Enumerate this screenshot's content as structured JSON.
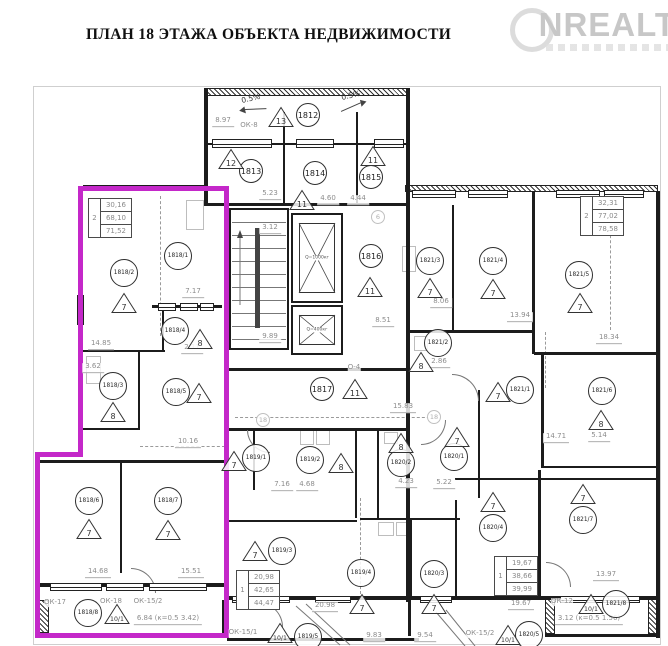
{
  "title": "ПЛАН 18 ЭТАЖА ОБЪЕКТА НЕДВИЖИМОСТИ",
  "watermark": {
    "text": "NREALT"
  },
  "colors": {
    "highlight": "#c428c9",
    "wall": "#1c1c1c",
    "dim_text": "#8d8d8d"
  },
  "rooms": [
    {
      "id": "1812",
      "x": 308,
      "y": 115,
      "tri": "13",
      "tx": 281,
      "ty": 117
    },
    {
      "id": "1813",
      "x": 251,
      "y": 171,
      "tri": "12",
      "tx": 231,
      "ty": 159
    },
    {
      "id": "1814",
      "x": 315,
      "y": 173,
      "tri": "11",
      "tx": 302,
      "ty": 200
    },
    {
      "id": "1815",
      "x": 371,
      "y": 177,
      "tri": "11",
      "tx": 373,
      "ty": 156
    },
    {
      "id": "1816",
      "x": 371,
      "y": 256,
      "tri": "11",
      "tx": 370,
      "ty": 287
    },
    {
      "id": "1817",
      "x": 322,
      "y": 389,
      "tri": "11",
      "tx": 355,
      "ty": 389
    },
    {
      "id": "1818/1",
      "x": 178,
      "y": 256,
      "tri": null,
      "tx": 0,
      "ty": 0
    },
    {
      "id": "1818/2",
      "x": 124,
      "y": 273,
      "tri": "7",
      "tx": 124,
      "ty": 303
    },
    {
      "id": "1818/3",
      "x": 113,
      "y": 386,
      "tri": "8",
      "tx": 113,
      "ty": 412
    },
    {
      "id": "1818/4",
      "x": 175,
      "y": 331,
      "tri": "8",
      "tx": 200,
      "ty": 339
    },
    {
      "id": "1818/5",
      "x": 176,
      "y": 392,
      "tri": "7",
      "tx": 199,
      "ty": 393
    },
    {
      "id": "1818/6",
      "x": 89,
      "y": 501,
      "tri": "7",
      "tx": 89,
      "ty": 529
    },
    {
      "id": "1818/7",
      "x": 168,
      "y": 501,
      "tri": "7",
      "tx": 168,
      "ty": 530
    },
    {
      "id": "1818/8",
      "x": 88,
      "y": 613,
      "tri": "10/1",
      "tx": 117,
      "ty": 614
    },
    {
      "id": "1819/1",
      "x": 256,
      "y": 458,
      "tri": "7",
      "tx": 234,
      "ty": 461
    },
    {
      "id": "1819/2",
      "x": 310,
      "y": 460,
      "tri": "8",
      "tx": 341,
      "ty": 463
    },
    {
      "id": "1819/3",
      "x": 282,
      "y": 551,
      "tri": "7",
      "tx": 255,
      "ty": 551
    },
    {
      "id": "1819/4",
      "x": 361,
      "y": 573,
      "tri": "7",
      "tx": 362,
      "ty": 604
    },
    {
      "id": "1819/5",
      "x": 308,
      "y": 637,
      "tri": "10/1",
      "tx": 280,
      "ty": 633
    },
    {
      "id": "1820/1",
      "x": 454,
      "y": 457,
      "tri": "7",
      "tx": 457,
      "ty": 437
    },
    {
      "id": "1820/2",
      "x": 401,
      "y": 463,
      "tri": "8",
      "tx": 401,
      "ty": 443
    },
    {
      "id": "1820/3",
      "x": 434,
      "y": 574,
      "tri": "7",
      "tx": 434,
      "ty": 604
    },
    {
      "id": "1820/4",
      "x": 493,
      "y": 528,
      "tri": "7",
      "tx": 493,
      "ty": 502
    },
    {
      "id": "1820/5",
      "x": 529,
      "y": 635,
      "tri": "10/1",
      "tx": 508,
      "ty": 635
    },
    {
      "id": "1821/1",
      "x": 520,
      "y": 390,
      "tri": "7",
      "tx": 498,
      "ty": 392
    },
    {
      "id": "1821/2",
      "x": 438,
      "y": 343,
      "tri": "8",
      "tx": 421,
      "ty": 362
    },
    {
      "id": "1821/3",
      "x": 430,
      "y": 261,
      "tri": "7",
      "tx": 430,
      "ty": 288
    },
    {
      "id": "1821/4",
      "x": 493,
      "y": 261,
      "tri": "7",
      "tx": 493,
      "ty": 289
    },
    {
      "id": "1821/5",
      "x": 579,
      "y": 275,
      "tri": "7",
      "tx": 580,
      "ty": 303
    },
    {
      "id": "1821/6",
      "x": 602,
      "y": 391,
      "tri": "8",
      "tx": 601,
      "ty": 420
    },
    {
      "id": "1821/7",
      "x": 583,
      "y": 520,
      "tri": "7",
      "tx": 583,
      "ty": 494
    },
    {
      "id": "1821/8",
      "x": 616,
      "y": 604,
      "tri": "10/1",
      "tx": 591,
      "ty": 604
    }
  ],
  "dims": [
    {
      "t": "8.97",
      "x": 223,
      "y": 122
    },
    {
      "t": "ОК-8",
      "x": 249,
      "y": 126
    },
    {
      "t": "5.23",
      "x": 270,
      "y": 195
    },
    {
      "t": "4.60",
      "x": 328,
      "y": 200
    },
    {
      "t": "4.44",
      "x": 358,
      "y": 200
    },
    {
      "t": "3.12",
      "x": 270,
      "y": 229
    },
    {
      "t": "9.89",
      "x": 270,
      "y": 338
    },
    {
      "t": "8.51",
      "x": 383,
      "y": 322
    },
    {
      "t": "7.17",
      "x": 193,
      "y": 293
    },
    {
      "t": "14.85",
      "x": 101,
      "y": 345
    },
    {
      "t": "3.62",
      "x": 93,
      "y": 368
    },
    {
      "t": "2.11",
      "x": 192,
      "y": 349
    },
    {
      "t": "10.16",
      "x": 188,
      "y": 443
    },
    {
      "t": "14.68",
      "x": 98,
      "y": 573
    },
    {
      "t": "15.51",
      "x": 191,
      "y": 573
    },
    {
      "t": "ОК-17",
      "x": 55,
      "y": 603
    },
    {
      "t": "ОК-18",
      "x": 111,
      "y": 602
    },
    {
      "t": "ОК-15/2",
      "x": 148,
      "y": 602
    },
    {
      "t": "6.84 (к=0.5  3.42)",
      "x": 168,
      "y": 620
    },
    {
      "t": "7.16",
      "x": 282,
      "y": 486
    },
    {
      "t": "4.68",
      "x": 307,
      "y": 486
    },
    {
      "t": "20.98",
      "x": 325,
      "y": 607
    },
    {
      "t": "ОК-15/1",
      "x": 243,
      "y": 633
    },
    {
      "t": "9.83",
      "x": 374,
      "y": 637
    },
    {
      "t": "9.54",
      "x": 425,
      "y": 637
    },
    {
      "t": "4.23",
      "x": 406,
      "y": 483
    },
    {
      "t": "5.22",
      "x": 444,
      "y": 484
    },
    {
      "t": "15.83",
      "x": 403,
      "y": 408
    },
    {
      "t": "8.06",
      "x": 441,
      "y": 303
    },
    {
      "t": "13.94",
      "x": 520,
      "y": 317
    },
    {
      "t": "18.34",
      "x": 609,
      "y": 339
    },
    {
      "t": "2.86",
      "x": 439,
      "y": 363
    },
    {
      "t": "14.71",
      "x": 556,
      "y": 438
    },
    {
      "t": "5.14",
      "x": 599,
      "y": 437
    },
    {
      "t": "13.97",
      "x": 606,
      "y": 576
    },
    {
      "t": "19.67",
      "x": 521,
      "y": 605
    },
    {
      "t": "ОК-12",
      "x": 562,
      "y": 602
    },
    {
      "t": "ОК-15/2",
      "x": 480,
      "y": 634
    },
    {
      "t": "3.12 (к=0.5  1.56)",
      "x": 589,
      "y": 620
    },
    {
      "t": "О-4",
      "x": 354,
      "y": 368
    }
  ],
  "axis_bubbles": [
    {
      "t": "6",
      "x": 378,
      "y": 217
    },
    {
      "t": "18",
      "x": 263,
      "y": 420
    },
    {
      "t": "18",
      "x": 434,
      "y": 417
    }
  ],
  "slopes": [
    {
      "t": "0.5%",
      "x": 252,
      "y": 104,
      "dir": "left"
    },
    {
      "t": "0.5%",
      "x": 352,
      "y": 101,
      "dir": "right"
    }
  ],
  "area_tables": [
    {
      "col": "2",
      "rows": [
        "30,16",
        "68,10",
        "71,52"
      ],
      "x": 88,
      "y": 198
    },
    {
      "col": "2",
      "rows": [
        "32,31",
        "77,02",
        "78,58"
      ],
      "x": 580,
      "y": 196
    },
    {
      "col": "1",
      "rows": [
        "20,98",
        "42,65",
        "44,47"
      ],
      "x": 236,
      "y": 570
    },
    {
      "col": "1",
      "rows": [
        "19,67",
        "38,66",
        "39,99"
      ],
      "x": 494,
      "y": 556
    }
  ],
  "elevators": [
    {
      "label": "Q=1000кг",
      "x": 291,
      "y": 213,
      "w": 52,
      "h": 90
    },
    {
      "label": "Q=400кг",
      "x": 291,
      "y": 305,
      "w": 52,
      "h": 50
    }
  ]
}
